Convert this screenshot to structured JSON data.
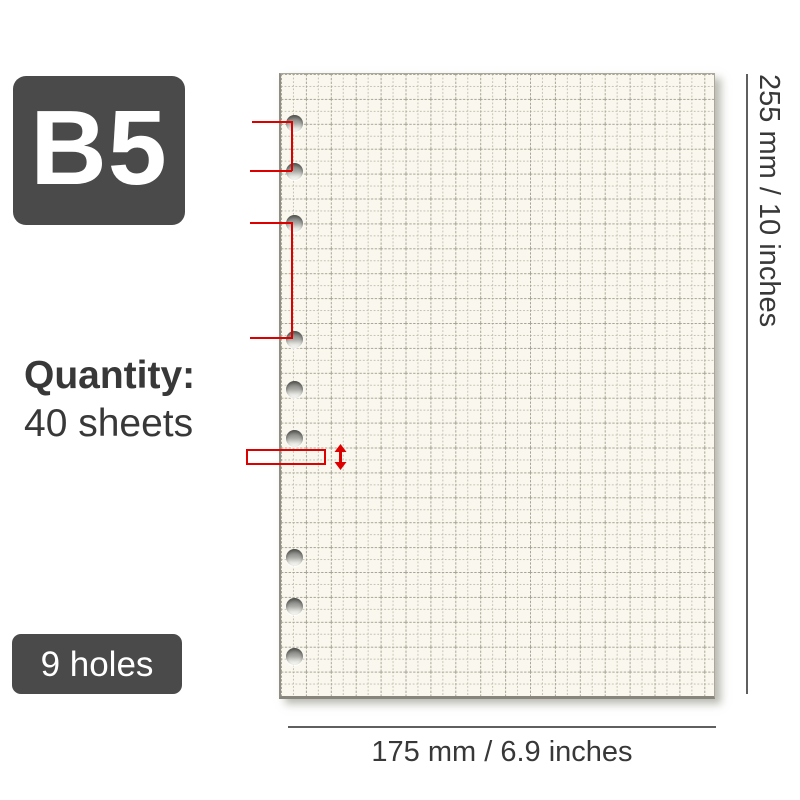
{
  "badges": {
    "size": "B5",
    "holes": "9 holes"
  },
  "quantity": {
    "label": "Quantity:",
    "value": "40 sheets"
  },
  "dimensions": {
    "height": "255 mm / 10 inches",
    "width": "175 mm / 6.9 inches"
  },
  "paper": {
    "type": "grid-ruled refill sheet",
    "hole_count": 9,
    "hole_groups": 3
  },
  "colors": {
    "badge_bg": "#4a4a4a",
    "annotation_red": "#dd0000",
    "paper_bg": "#faf8ee",
    "grid_minor": "#c2bfb2",
    "grid_major": "#a8a497",
    "dimension_line": "#5f5f5f",
    "text": "#383838"
  }
}
